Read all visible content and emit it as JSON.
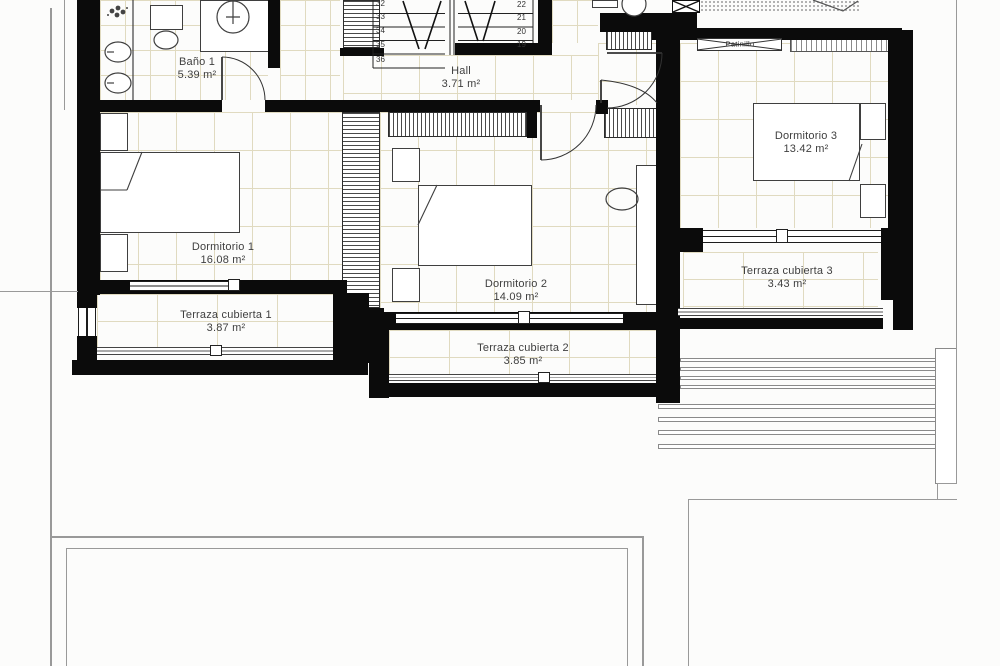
{
  "title": "Planta alta - plano de vivienda",
  "rooms": {
    "bano": {
      "name": "Baño 1",
      "area": "5.39 m²"
    },
    "hall": {
      "name": "Hall",
      "area": "3.71 m²"
    },
    "dormitorio1": {
      "name": "Dormitorio 1",
      "area": "16.08 m²"
    },
    "dormitorio2": {
      "name": "Dormitorio 2",
      "area": "14.09 m²"
    },
    "dormitorio3": {
      "name": "Dormitorio 3",
      "area": "13.42 m²"
    },
    "terraza1": {
      "name": "Terraza cubierta 1",
      "area": "3.87 m²"
    },
    "terraza2": {
      "name": "Terraza cubierta 2",
      "area": "3.85 m²"
    },
    "terraza3": {
      "name": "Terraza cubierta 3",
      "area": "3.43 m²"
    }
  },
  "shaft_label": "Patinillo",
  "stairs": {
    "left_flight": [
      "32",
      "33",
      "34",
      "35",
      "36"
    ],
    "right_flight": [
      "22",
      "21",
      "20",
      "19"
    ]
  },
  "colors": {
    "wall": "#0b0b0b",
    "tile_line": "#cfc49a",
    "furniture_line": "#3f3f3f",
    "boundary_line": "#999999",
    "text": "#3f3f3f"
  }
}
